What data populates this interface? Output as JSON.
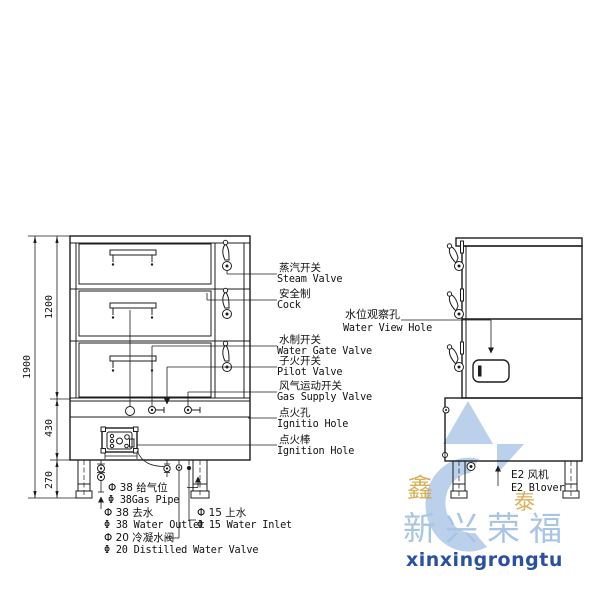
{
  "diagram_type": "steam-cabinet-technical-drawing",
  "dimensions": {
    "overall_height": "1900",
    "upper_section": "1200",
    "middle_section": "430",
    "lower_section": "270"
  },
  "labels": {
    "steam_valve": {
      "zh": "蒸汽开关",
      "en": "Steam Valve"
    },
    "cock": {
      "zh": "安全制",
      "en": "Cock"
    },
    "water_view_hole": {
      "zh": "水位观察孔",
      "en": "Water View Hole"
    },
    "water_gate_valve": {
      "zh": "水制开关",
      "en": "Water Gate Valve"
    },
    "pilot_valve": {
      "zh": "子火开关",
      "en": "Pilot Valve"
    },
    "gas_supply_valve": {
      "zh": "风气运动开关",
      "en": "Gas Supply Valve"
    },
    "ignition_hole": {
      "zh": "点火孔",
      "en": "Ignitio Hole"
    },
    "ignition_rod": {
      "zh": "点火棒",
      "en": "Ignition Hole"
    },
    "gas_pipe": {
      "zh": "Φ 38 给气位",
      "en": "Φ 38Gas Pipe"
    },
    "water_outlet": {
      "zh": "Φ 38 去水",
      "en": "Φ 38 Water Outlet"
    },
    "distilled_water_valve": {
      "zh": "Φ 20 冷凝水阀",
      "en": "Φ 20 Distilled Water Valve"
    },
    "water_inlet": {
      "zh": "Φ 15 上水",
      "en": "Φ 15 Water Inlet"
    },
    "blower": {
      "zh": "E2 风机",
      "en": "E2 Blover"
    }
  },
  "watermark": {
    "company_cn": "新兴荣福",
    "company_en": "xinxingrongtu",
    "seal_left": "鑫",
    "seal_right": "泰",
    "colors": {
      "light_blue": "#b3cbe9",
      "text_blue": "#a9c5e4",
      "dark_blue": "#2b50a2",
      "gold": "#d1a33c"
    }
  },
  "line_color": "#1c1c1c",
  "background": "#ffffff"
}
